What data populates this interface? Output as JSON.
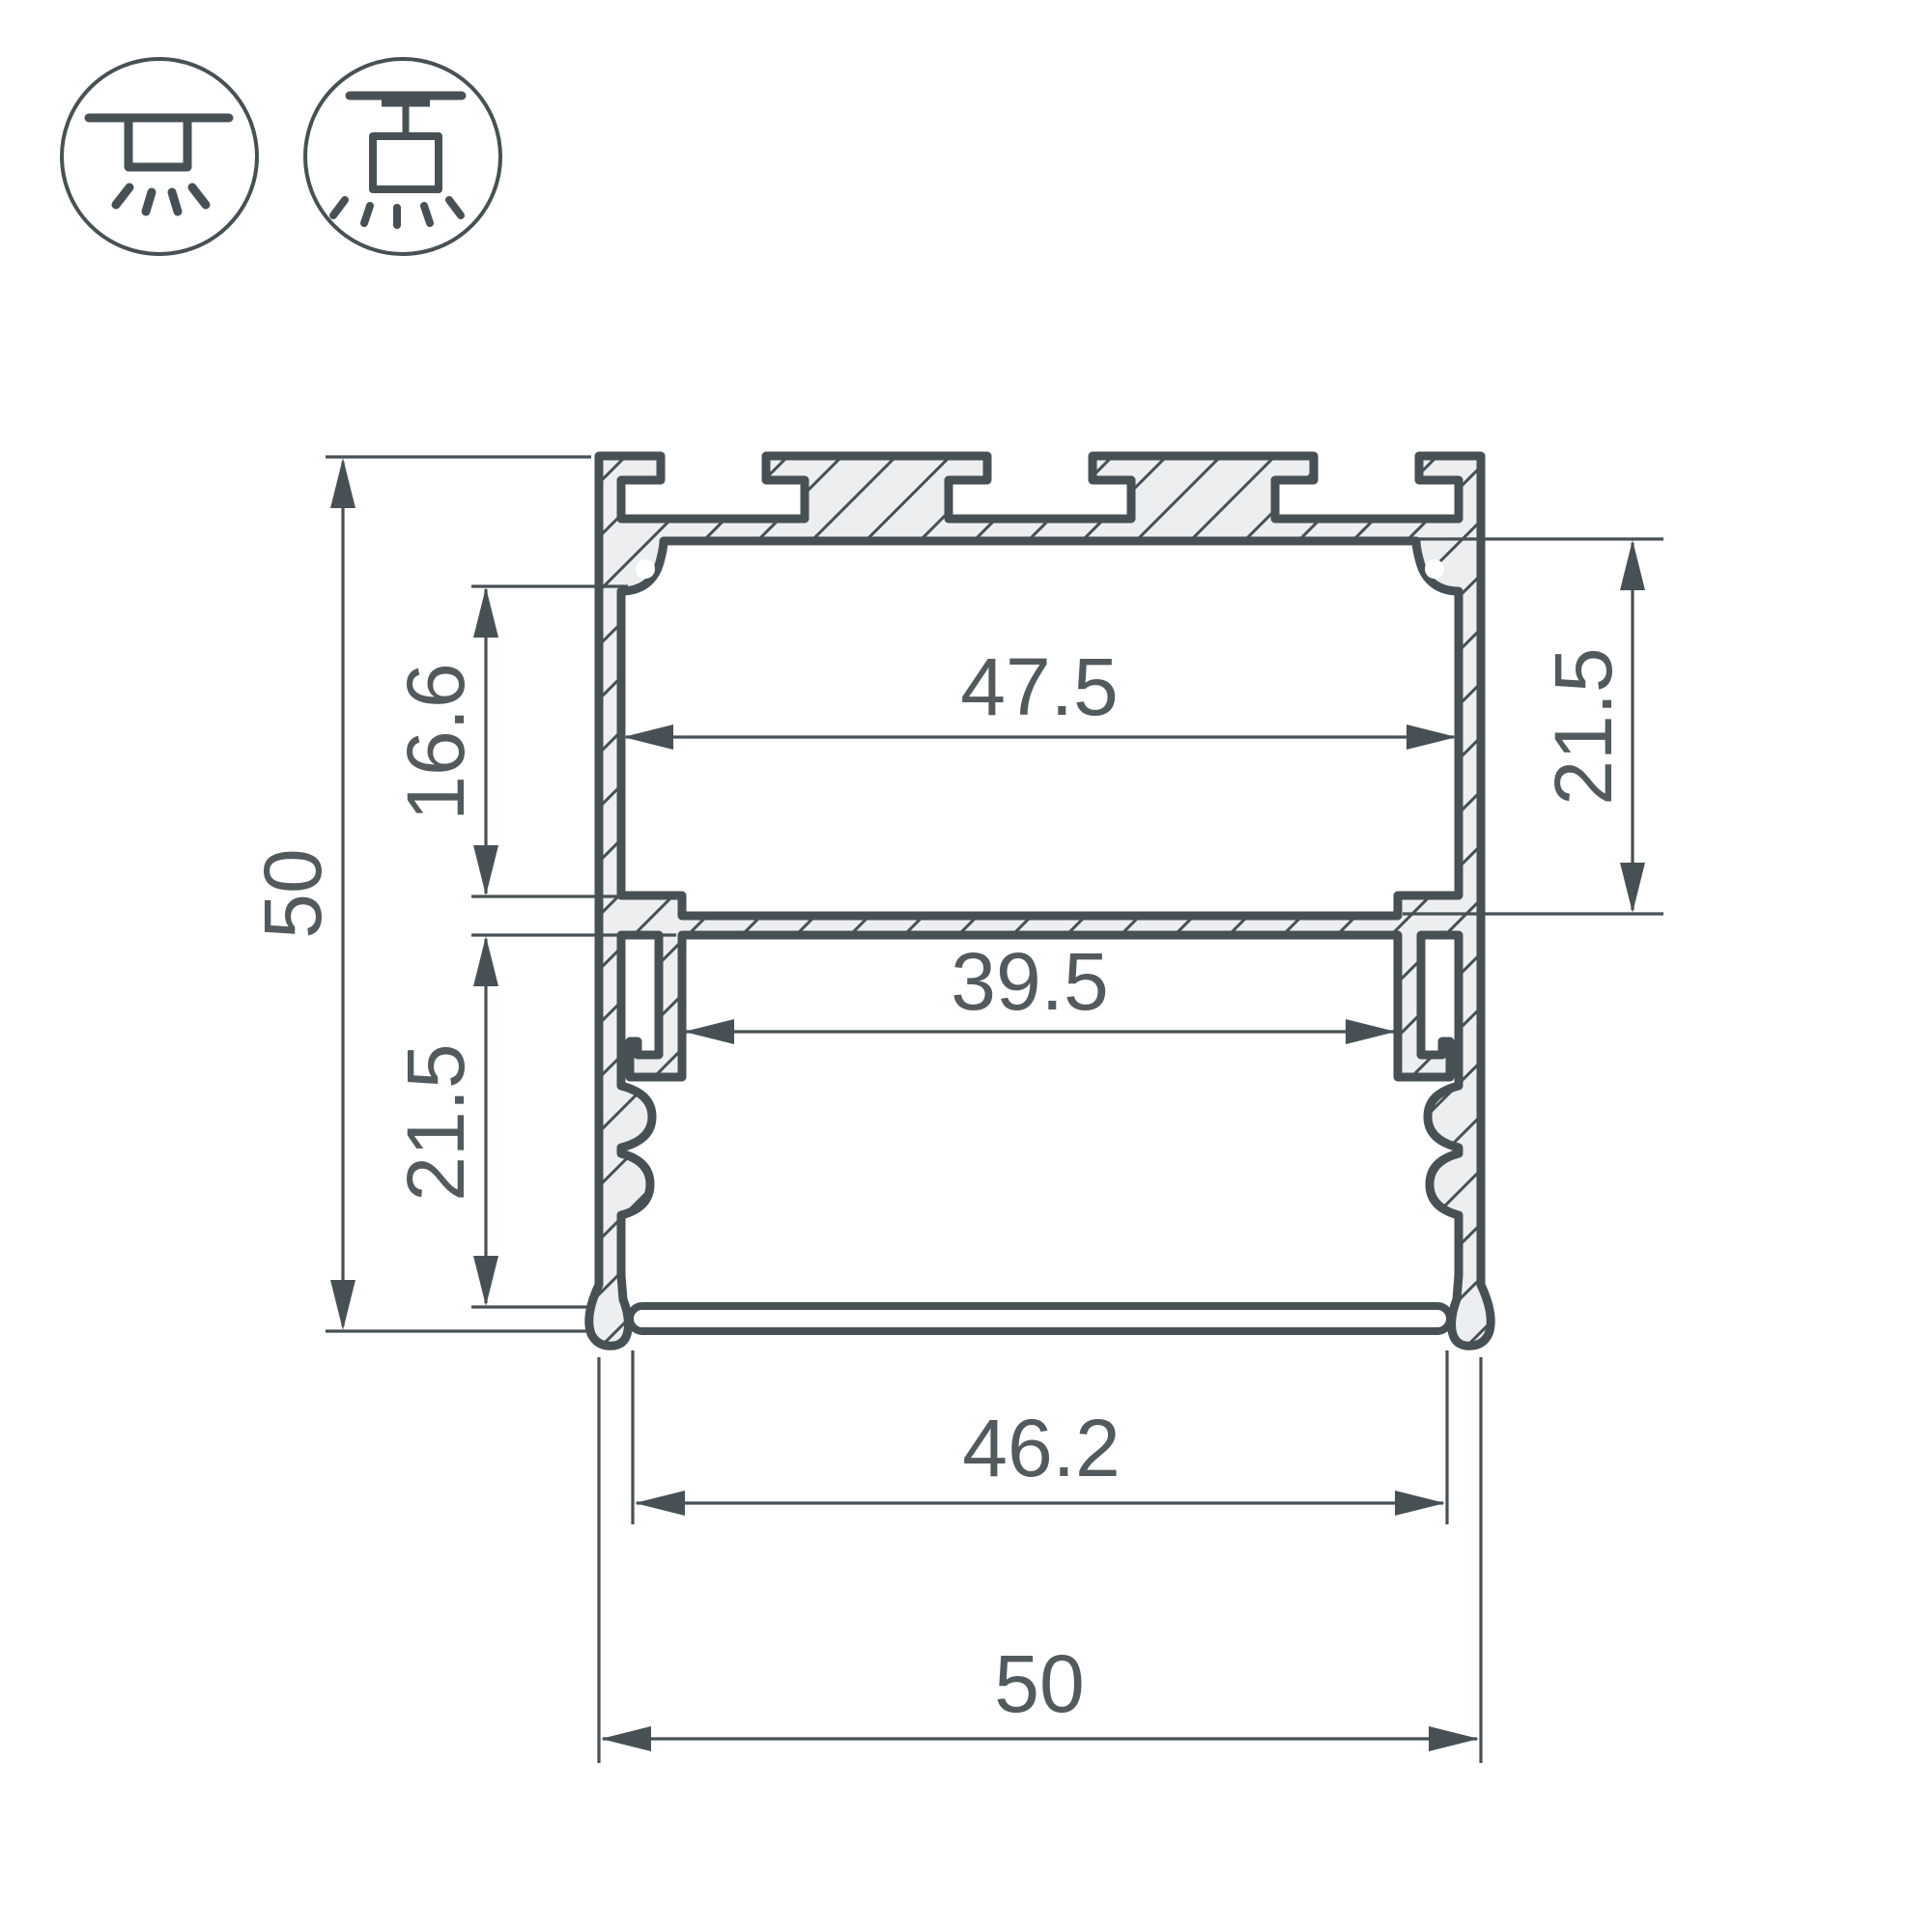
{
  "page": {
    "background": "#ffffff",
    "kind": "technical drawing — aluminium LED profile cross-section"
  },
  "colors": {
    "outline": "#475155",
    "metal_fill": "#eceeef",
    "hatch": "#475155",
    "dimension_text": "#525a5d"
  },
  "icons": [
    {
      "name": "surface-mount-icon",
      "meaning": "surface ceiling mount luminaire"
    },
    {
      "name": "pendant-mount-icon",
      "meaning": "suspended / pendant mount luminaire"
    }
  ],
  "drawing": {
    "type": "profile-cross-section",
    "dims": {
      "height_overall": "50",
      "top_to_shelf_offset": "16.6",
      "lower_chamber_height": "21.5",
      "upper_inner_width": "47.5",
      "upper_chamber_height": "21.5",
      "shelf_opening_width": "39.5",
      "bottom_inner_width": "46.2",
      "width_overall": "50"
    }
  }
}
